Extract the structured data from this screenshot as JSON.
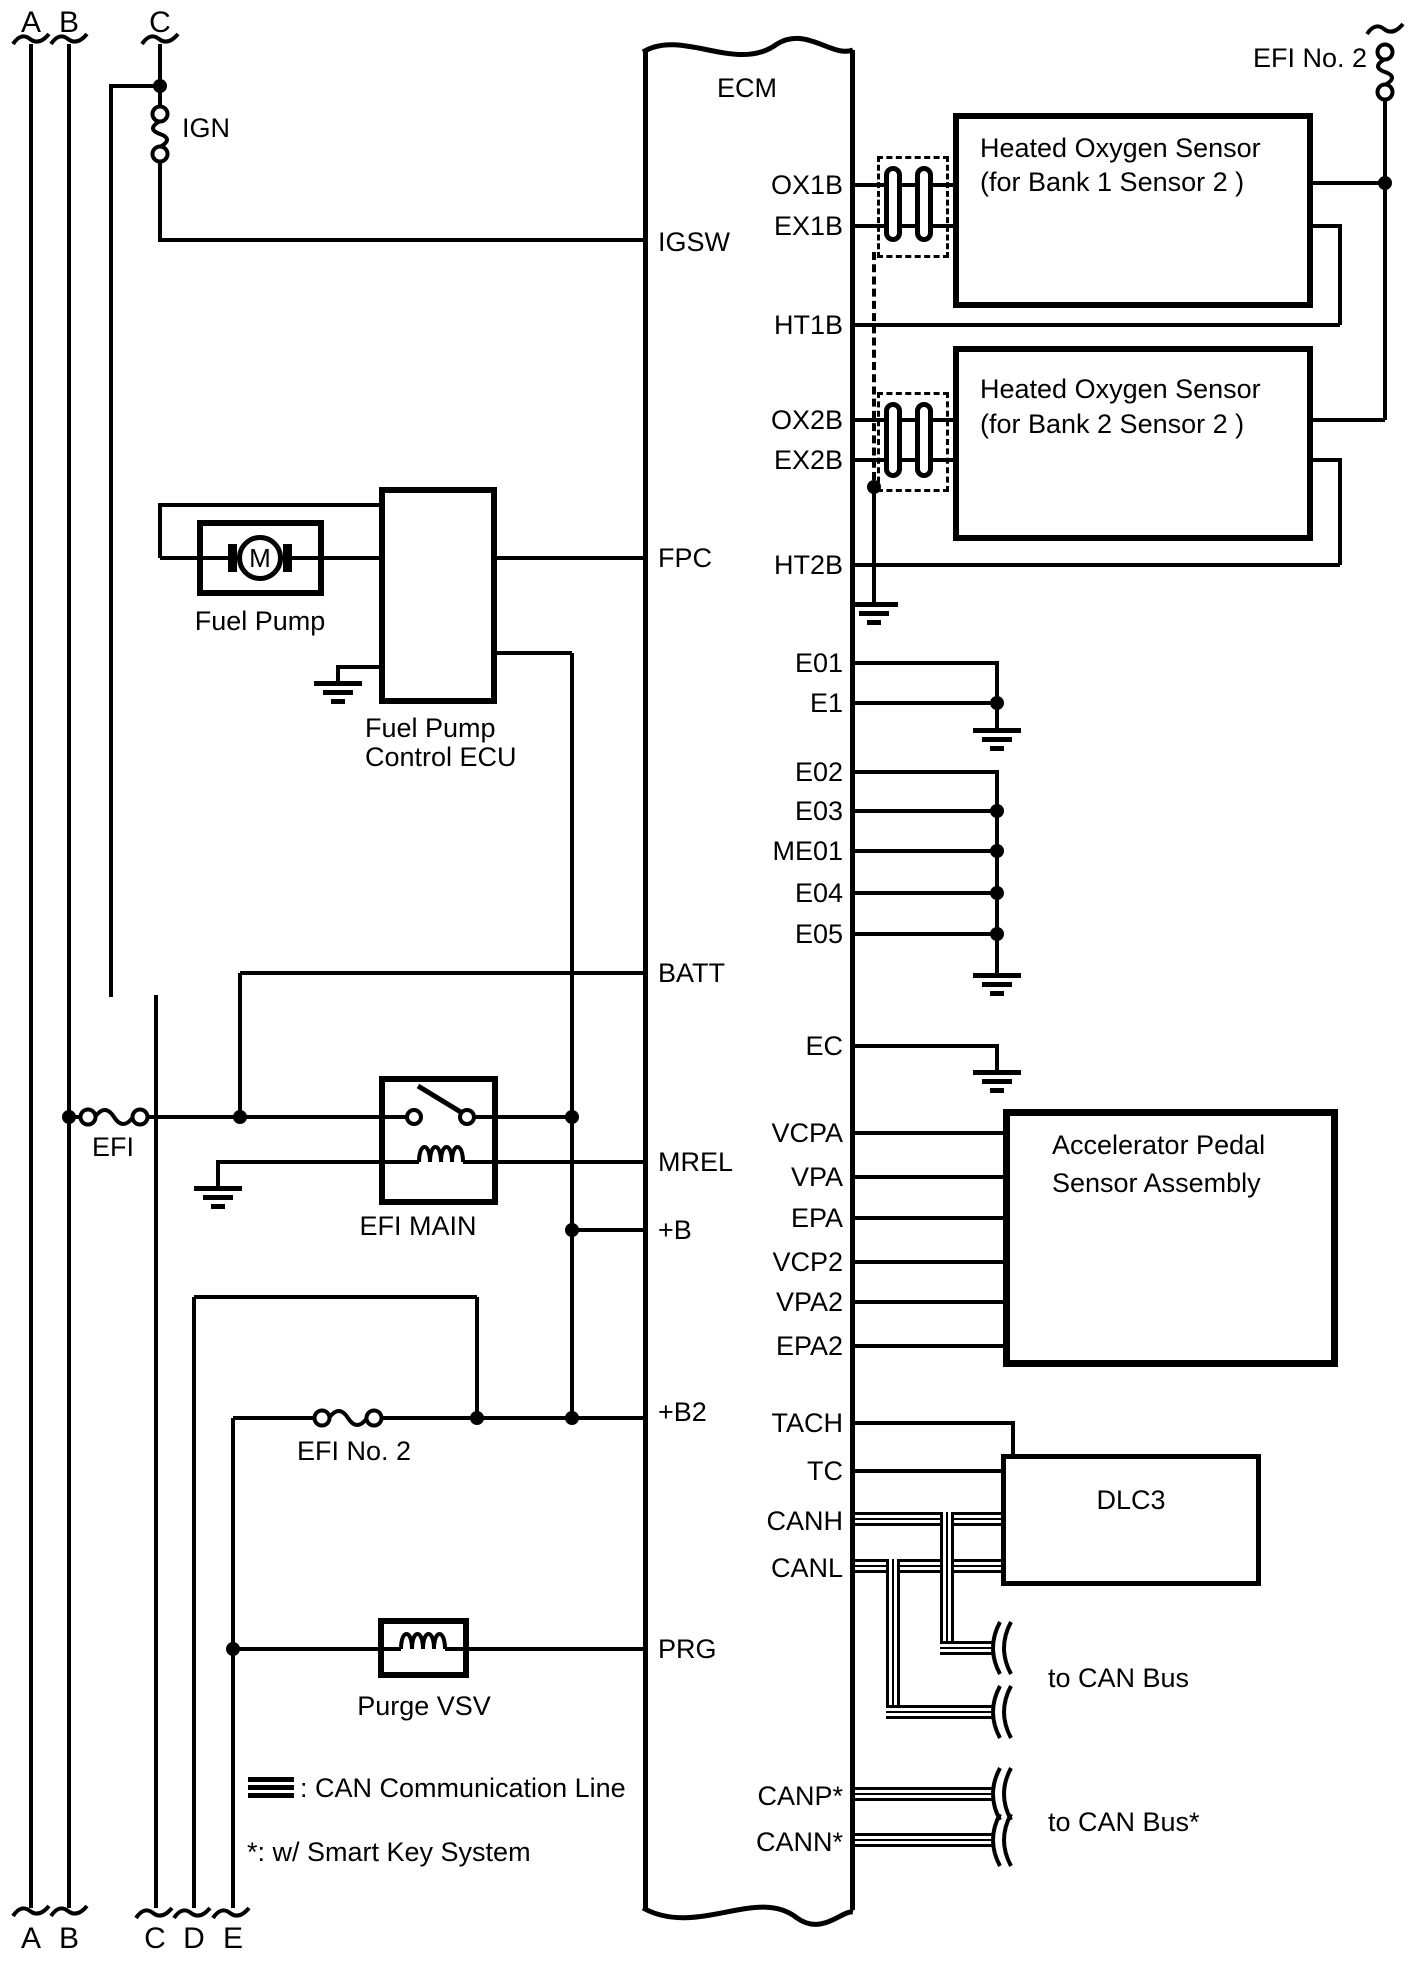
{
  "canvas": {
    "ink": "#000000",
    "paper": "#ffffff"
  },
  "ecm": {
    "label": "ECM"
  },
  "rails": {
    "a": "A",
    "b": "B",
    "c": "C",
    "d": "D",
    "e": "E"
  },
  "fuses": {
    "ign": "IGN",
    "efi": "EFI",
    "efi_no2": "EFI No. 2"
  },
  "pins": {
    "left": [
      {
        "label": "IGSW"
      },
      {
        "label": "FPC"
      },
      {
        "label": "BATT"
      },
      {
        "label": "MREL"
      },
      {
        "label": "+B"
      },
      {
        "label": "+B2"
      },
      {
        "label": "PRG"
      }
    ],
    "right": [
      {
        "label": "OX1B"
      },
      {
        "label": "EX1B"
      },
      {
        "label": "HT1B"
      },
      {
        "label": "OX2B"
      },
      {
        "label": "EX2B"
      },
      {
        "label": "HT2B"
      },
      {
        "label": "E01"
      },
      {
        "label": "E1"
      },
      {
        "label": "E02"
      },
      {
        "label": "E03"
      },
      {
        "label": "ME01"
      },
      {
        "label": "E04"
      },
      {
        "label": "E05"
      },
      {
        "label": "EC"
      },
      {
        "label": "VCPA"
      },
      {
        "label": "VPA"
      },
      {
        "label": "EPA"
      },
      {
        "label": "VCP2"
      },
      {
        "label": "VPA2"
      },
      {
        "label": "EPA2"
      },
      {
        "label": "TACH"
      },
      {
        "label": "TC"
      },
      {
        "label": "CANH"
      },
      {
        "label": "CANL"
      },
      {
        "label": "CANP*"
      },
      {
        "label": "CANN*"
      }
    ]
  },
  "components": {
    "ho2s1": {
      "line1": "Heated Oxygen Sensor",
      "line2": "(for Bank 1 Sensor 2 )"
    },
    "ho2s2": {
      "line1": "Heated Oxygen Sensor",
      "line2": "(for Bank 2 Sensor 2 )"
    },
    "fuel_pump": {
      "label": "Fuel Pump",
      "motor": "M"
    },
    "fp_ecu": {
      "line1": "Fuel Pump",
      "line2": "Control ECU"
    },
    "efi_main": {
      "label": "EFI MAIN"
    },
    "purge": {
      "label": "Purge VSV"
    },
    "accel": {
      "line1": "Accelerator Pedal",
      "line2": "Sensor Assembly"
    },
    "dlc3": {
      "label": "DLC3"
    }
  },
  "notes": {
    "to_can_bus": "to CAN Bus",
    "to_can_bus_star": "to CAN Bus*",
    "legend_can": ": CAN Communication Line",
    "legend_star": "*: w/ Smart Key System"
  }
}
